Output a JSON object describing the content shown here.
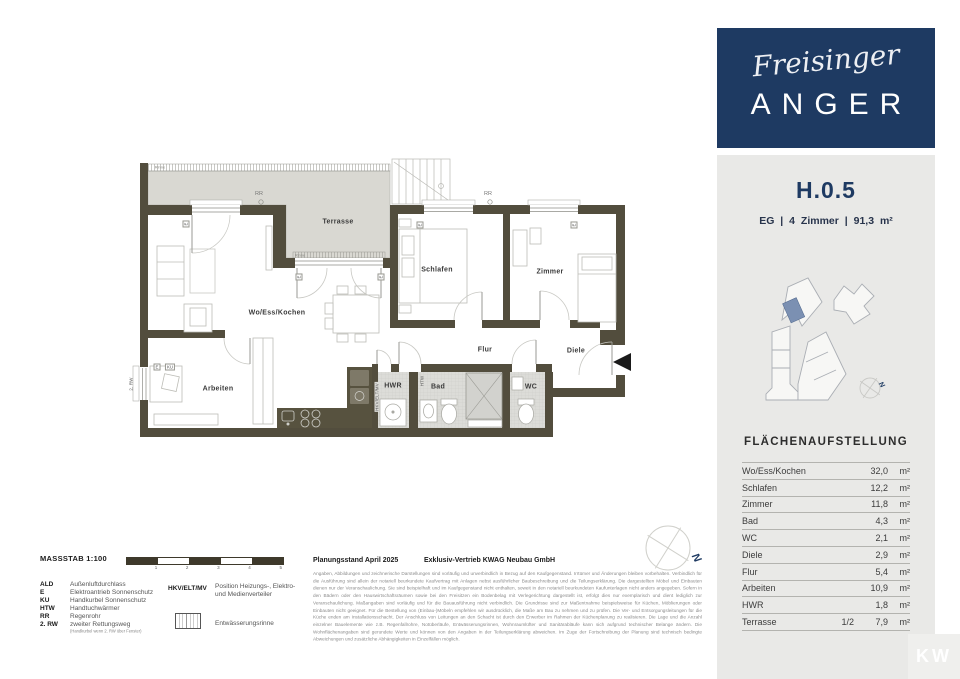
{
  "brand": {
    "script": "Freisinger",
    "caps": "ANGER"
  },
  "unit": {
    "title": "H.0.5",
    "subtitle": "EG | 4 Zimmer | 91,3 m²"
  },
  "plan": {
    "rooms": {
      "terrasse": "Terrasse",
      "wohnen": "Wo/Ess/Kochen",
      "schlafen": "Schlafen",
      "zimmer": "Zimmer",
      "arbeiten": "Arbeiten",
      "hwr": "HWR",
      "bad": "Bad",
      "wc": "WC",
      "flur": "Flur",
      "diele": "Diele"
    },
    "marks": {
      "rr": "RR",
      "e": "E",
      "ku": "KU",
      "rw": "2. RW",
      "hkv": "HKV/ELT/MV",
      "htw": "HTW",
      "rinne": "Rinne"
    }
  },
  "area_table": {
    "title": "FLÄCHENAUFSTELLUNG",
    "rows": [
      {
        "label": "Wo/Ess/Kochen",
        "factor": "",
        "value": "32,0",
        "unit": "m²"
      },
      {
        "label": "Schlafen",
        "factor": "",
        "value": "12,2",
        "unit": "m²"
      },
      {
        "label": "Zimmer",
        "factor": "",
        "value": "11,8",
        "unit": "m²"
      },
      {
        "label": "Bad",
        "factor": "",
        "value": "4,3",
        "unit": "m²"
      },
      {
        "label": "WC",
        "factor": "",
        "value": "2,1",
        "unit": "m²"
      },
      {
        "label": "Diele",
        "factor": "",
        "value": "2,9",
        "unit": "m²"
      },
      {
        "label": "Flur",
        "factor": "",
        "value": "5,4",
        "unit": "m²"
      },
      {
        "label": "Arbeiten",
        "factor": "",
        "value": "10,9",
        "unit": "m²"
      },
      {
        "label": "HWR",
        "factor": "",
        "value": "1,8",
        "unit": "m²"
      },
      {
        "label": "Terrasse",
        "factor": "1/2",
        "value": "7,9",
        "unit": "m²"
      }
    ]
  },
  "legend": {
    "massstab": "MASSSTAB 1:100",
    "ticks": [
      "1",
      "2",
      "3",
      "4",
      "5"
    ],
    "items": [
      {
        "abbr": "ALD",
        "desc": "Außenluftdurchlass"
      },
      {
        "abbr": "E",
        "desc": "Elektroantrieb Sonnenschutz"
      },
      {
        "abbr": "KU",
        "desc": "Handkurbel Sonnenschutz"
      },
      {
        "abbr": "HTW",
        "desc": "Handtuchwärmer"
      },
      {
        "abbr": "RR",
        "desc": "Regenrohr"
      },
      {
        "abbr": "2. RW",
        "desc": "zweiter Rettungsweg"
      }
    ],
    "rw_note": "(Handkurbel wenn 2. RW über Fenster)",
    "hkv_abbr": "HKV/ELT/MV",
    "hkv_desc": "Position Heizungs-, Elektro- und Medienverteiler",
    "rinne_desc": "Entwässerungsrinne"
  },
  "footer": {
    "planungsstand": "Planungsstand April 2025",
    "vertrieb": "Exklusiv-Vertrieb  KWAG Neubau GmbH",
    "disclaimer": "Angaben, Abbildungen und zeichnerische Darstellungen sind vorläufig und unverbindlich in Bezug auf den Kaufgegenstand. Irrtümer und Änderungen bleiben vorbehalten. Verbindlich für die Ausführung sind allein der notariell beurkundete Kaufvertrag mit Anlagen nebst ausführlicher Baubeschreibung und die Teilungserklärung. Die dargestellten Möbel und Einbauten dienen nur der Veranschaulichung. Sie sind beispielhaft und im Kaufgegenstand nicht enthalten, soweit in den notariell beurkundeten Kaufunterlagen nicht anders angegeben. Sofern in den Bädern oder den Hauswirtschaftsräumen sowie bei den Freisitzen ein Bodenbelag mit Verlegerichtung dargestellt ist, erfolgt dies nur exemplarisch und dient lediglich zur Veranschaulichung. Maßangaben sind vorläufig und für die Bauausführung nicht verbindlich. Die Grundrisse sind zur Maßentnahme beispielsweise für Küchen, Möblierungen oder Einbauten nicht geeignet. Für die Bestellung von (Einbau-)Möbeln empfehlen wir ausdrücklich, die Maße am Bau zu nehmen und zu prüfen. Die Ver- und Entsorgungsleitungen für die Küche enden am Installationsschacht. Der Anschluss von Leitungen an den Schacht ist durch den Erwerber im Rahmen der Küchenplanung zu realisieren. Die Lage und die Anzahl einzelner Bauelemente wie z.B. Regenfallrohre, Notüberläufe, Entwässerungsrinnen, Wohnraumlüfter und Sanitärabläufe kann sich aufgrund technischer Belange ändern. Die Wohnflächenangaben sind gerundete Werte und können von den Angaben in der Teilungserklärung abweichen. Im Zuge der Fortschreibung der Planung sind technisch bedingte Abweichungen und zusätzliche Abhängigkeiten in Einzelfällen möglich."
  },
  "compass": {
    "label": "N"
  },
  "watermark": {
    "text": "KW"
  },
  "colors": {
    "navy": "#1e3a62",
    "wall": "#524d3d",
    "terrace": "#d9d8d2",
    "unit_highlight": "#7b90b2"
  }
}
